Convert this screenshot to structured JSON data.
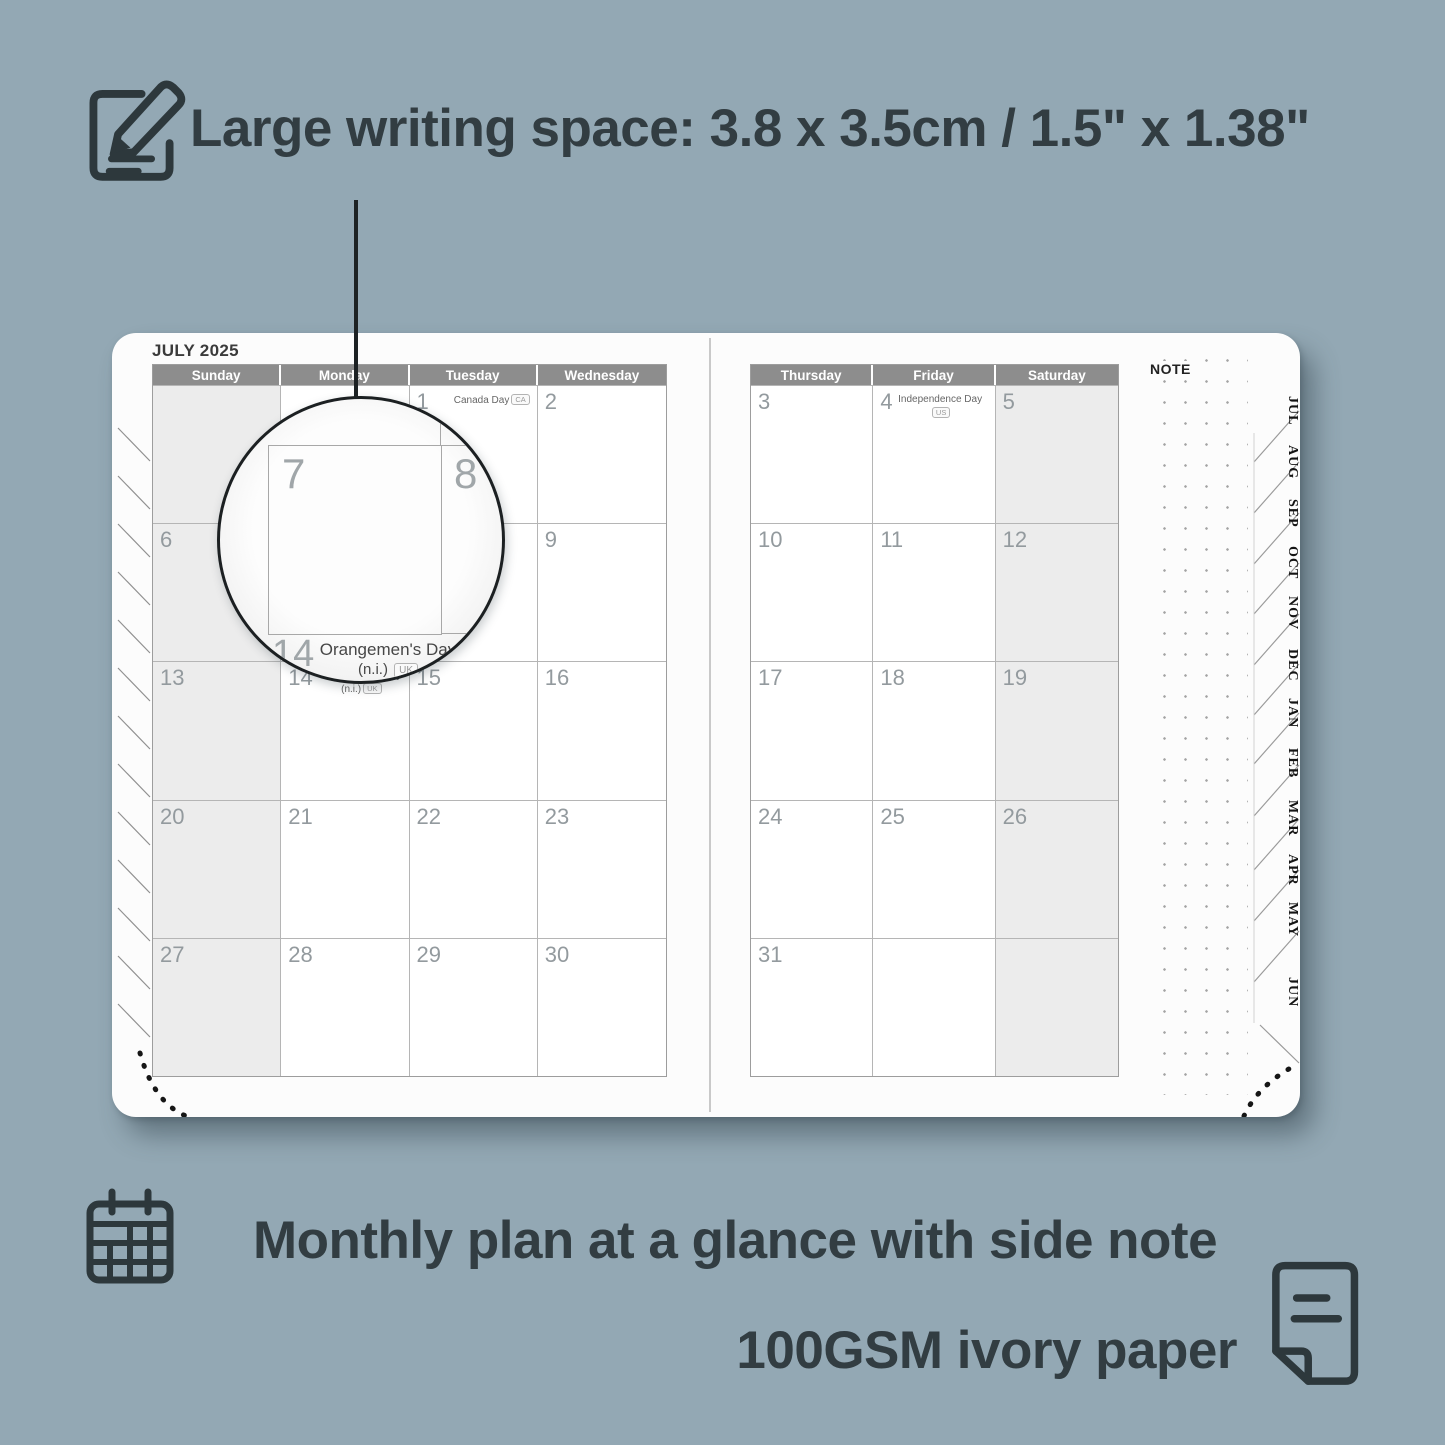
{
  "colors": {
    "background": "#93a8b4",
    "ink": "#323d42",
    "header_bar": "#8d8d8d",
    "shaded_cell": "#ececec",
    "day_number": "#939a9e"
  },
  "icons": {
    "top": "note-edit-icon",
    "bottom_left": "calendar-grid-icon",
    "bottom_right": "paper-sheet-icon"
  },
  "heading": "Large writing space: 3.8 x 3.5cm / 1.5\" x 1.38\"",
  "captions": {
    "monthly": "Monthly plan at a glance with side note",
    "paper": "100GSM ivory paper"
  },
  "planner": {
    "month_title": "JULY 2025",
    "note_label": "NOTE",
    "left_headers": [
      "Sunday",
      "Monday",
      "Tuesday",
      "Wednesday"
    ],
    "right_headers": [
      "Thursday",
      "Friday",
      "Saturday"
    ],
    "left_weeks": [
      [
        {
          "day": ""
        },
        {
          "day": ""
        },
        {
          "day": "1",
          "holiday": "Canada Day",
          "badge": "CA"
        },
        {
          "day": "2"
        }
      ],
      [
        {
          "day": "6"
        },
        {
          "day": "7"
        },
        {
          "day": "8"
        },
        {
          "day": "9"
        }
      ],
      [
        {
          "day": "13"
        },
        {
          "day": "14",
          "holiday_l1": "Orangemen's Day",
          "holiday_l2": "(n.i.)",
          "badge": "UK"
        },
        {
          "day": "15"
        },
        {
          "day": "16"
        }
      ],
      [
        {
          "day": "20"
        },
        {
          "day": "21"
        },
        {
          "day": "22"
        },
        {
          "day": "23"
        }
      ],
      [
        {
          "day": "27"
        },
        {
          "day": "28"
        },
        {
          "day": "29"
        },
        {
          "day": "30"
        }
      ]
    ],
    "right_weeks": [
      [
        {
          "day": "3"
        },
        {
          "day": "4",
          "holiday": "Independence Day",
          "badge": "US"
        },
        {
          "day": "5"
        }
      ],
      [
        {
          "day": "10"
        },
        {
          "day": "11"
        },
        {
          "day": "12"
        }
      ],
      [
        {
          "day": "17"
        },
        {
          "day": "18"
        },
        {
          "day": "19"
        }
      ],
      [
        {
          "day": "24"
        },
        {
          "day": "25"
        },
        {
          "day": "26"
        }
      ],
      [
        {
          "day": "31"
        },
        {
          "day": ""
        },
        {
          "day": ""
        }
      ]
    ],
    "tabs": [
      "JUL",
      "AUG",
      "SEP",
      "OCT",
      "NOV",
      "DEC",
      "JAN",
      "FEB",
      "MAR",
      "APR",
      "MAY",
      "JUN"
    ]
  },
  "magnifier": {
    "day_a": "7",
    "day_b": "8",
    "day_c": "14",
    "holiday_l1": "Orangemen's Day",
    "holiday_l2": "(n.i.)",
    "badge": "UK"
  }
}
